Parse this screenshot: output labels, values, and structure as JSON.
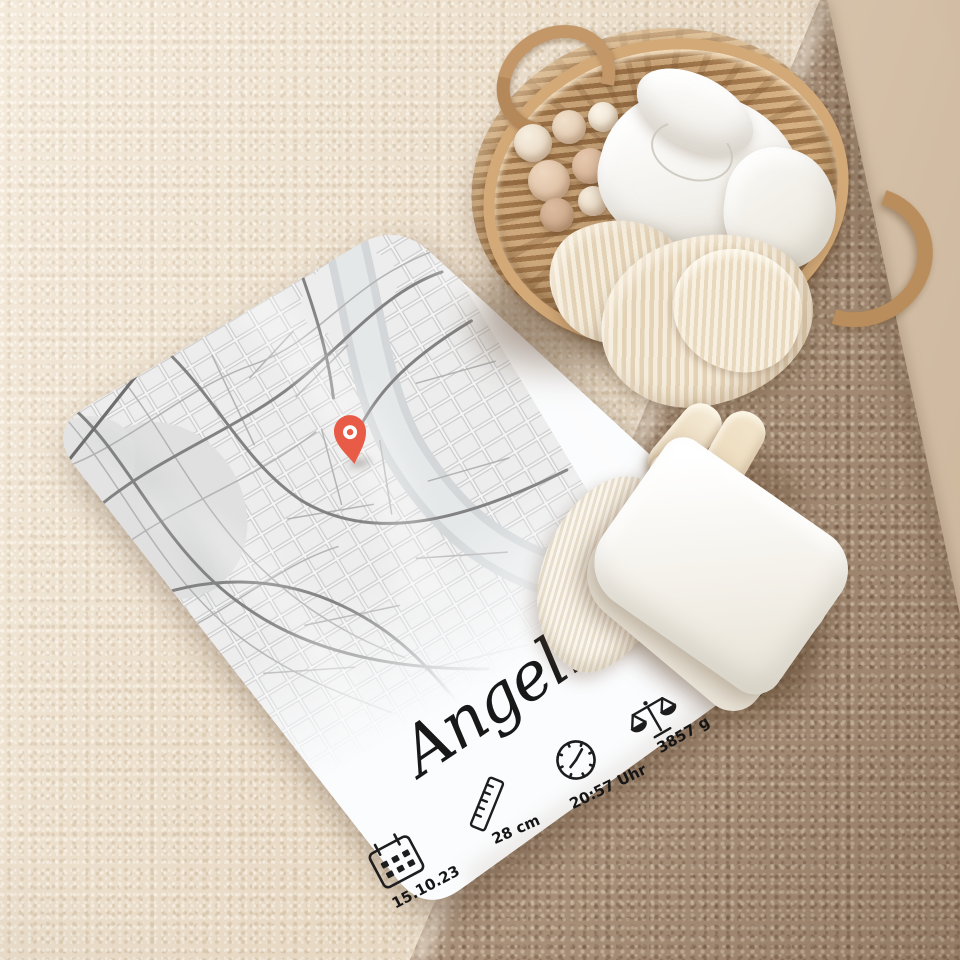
{
  "product": {
    "name_text": "Angelina",
    "birth_stats": [
      {
        "icon": "calendar-icon",
        "label": "15.10.23"
      },
      {
        "icon": "ruler-icon",
        "label": "28 cm"
      },
      {
        "icon": "clock-icon",
        "label": "20:57 Uhr"
      },
      {
        "icon": "scales-icon",
        "label": "3857 g"
      },
      {
        "icon": "hospital-icon",
        "label": "Mainz"
      }
    ],
    "map_pin_color": "#e85b46"
  },
  "palette": {
    "blanket_white": "#fbfcfd",
    "map_road_dark": "#828282",
    "map_road_light": "#b3b3b3",
    "map_river": "#d3d7d9",
    "carpet_cream": "#ecdfcc",
    "carpet_taupe": "#b1977f",
    "wall_beige": "#dcc9b2",
    "wicker_tan": "#c69c6c",
    "knit_cream": "#f0e4cd",
    "text_ink": "#1b1b1b"
  }
}
